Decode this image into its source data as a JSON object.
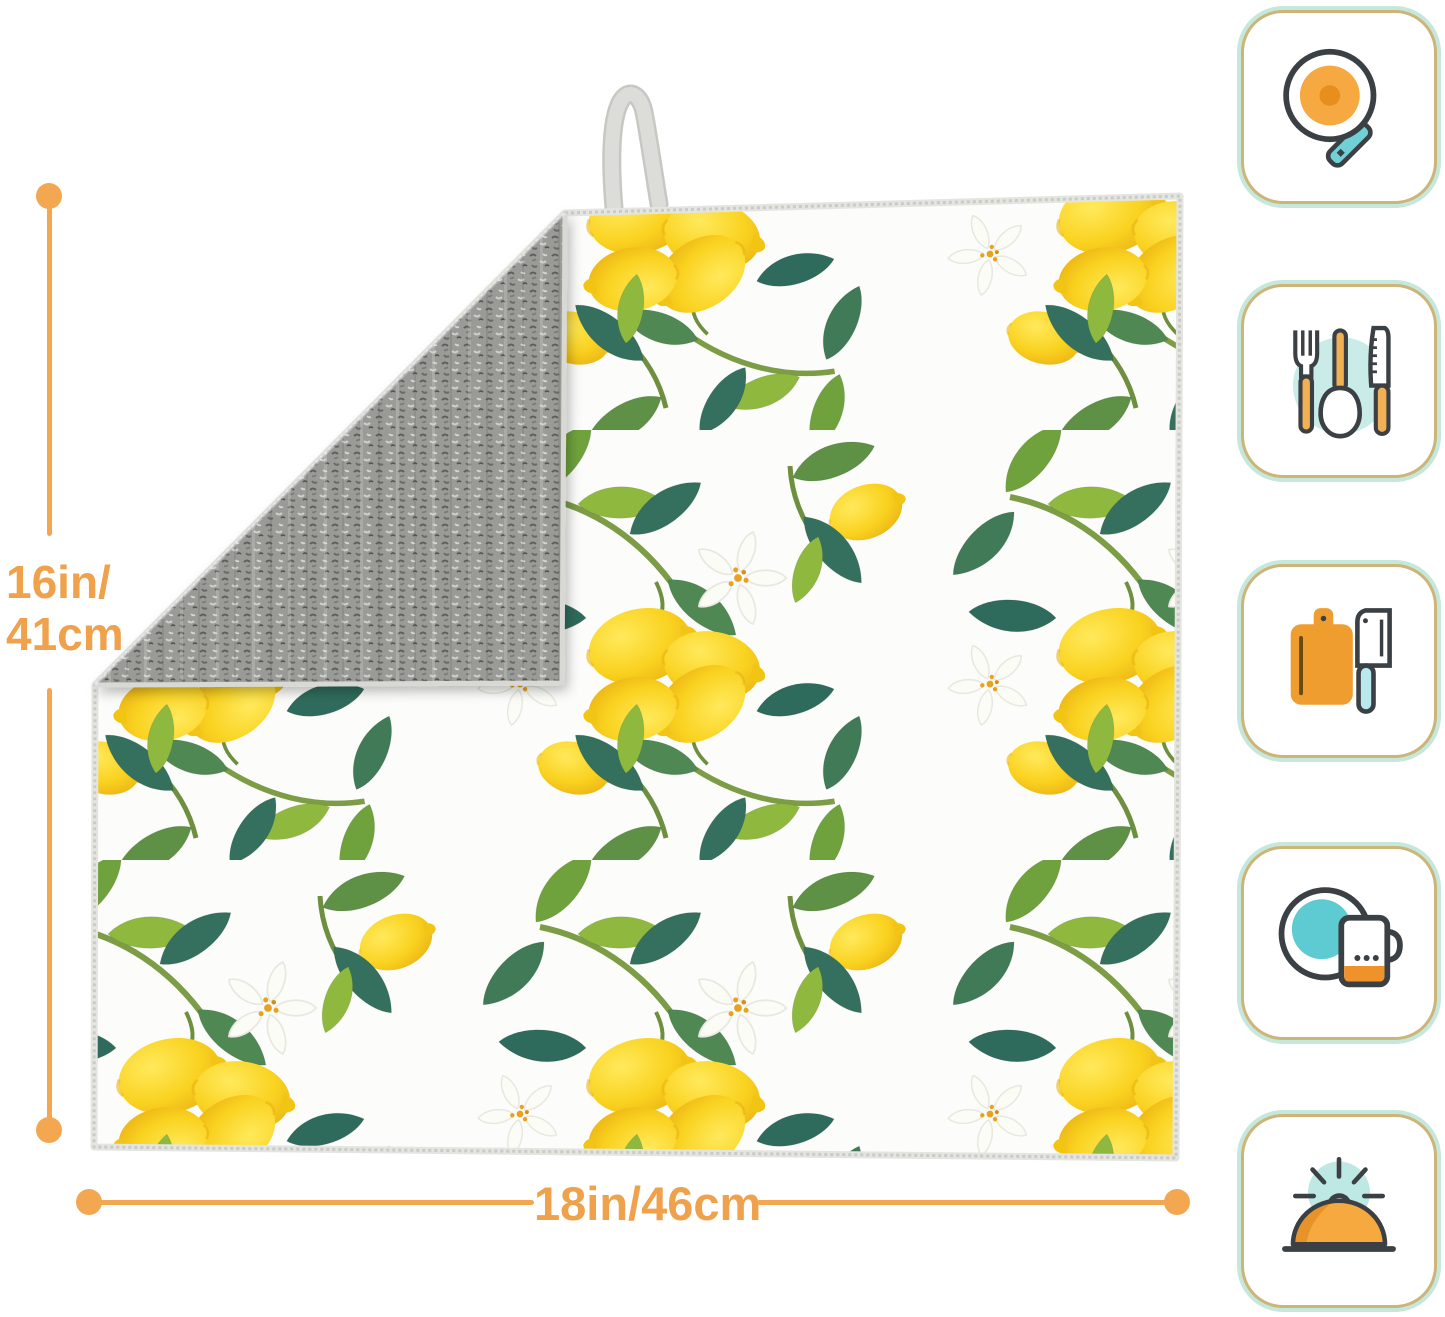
{
  "page": {
    "background_color": "#FFFFFF"
  },
  "dimensions": {
    "accent_color": "#F2A750",
    "height": {
      "line1": "16in/",
      "line2": "41cm"
    },
    "width": {
      "label": "18in/46cm"
    }
  },
  "product": {
    "kind": "dish-drying-mat",
    "front_pattern": "watercolor lemons, green leaves and white blossoms on white fabric",
    "lemon_yellow": "#F8D41B",
    "leaf_green": "#6FA23C",
    "leaf_teal": "#35705E",
    "back_texture_color": "#9A9A96",
    "binding_color": "#E4E4E0",
    "hanging_loop_color": "#DBDBD7"
  },
  "icons": [
    {
      "name": "frying-pan-icon"
    },
    {
      "name": "cutlery-icon"
    },
    {
      "name": "cutting-board-cleaver-icon"
    },
    {
      "name": "plate-mug-icon"
    },
    {
      "name": "cloche-icon"
    }
  ],
  "icon_style": {
    "border_gold": "#CDB579",
    "border_mint": "#C6E8DC",
    "outline": "#3B4045",
    "orange": "#F2A23C",
    "orange_dark": "#E78F1E",
    "teal": "#6FD0D6",
    "light_teal": "#C9ECE9"
  }
}
